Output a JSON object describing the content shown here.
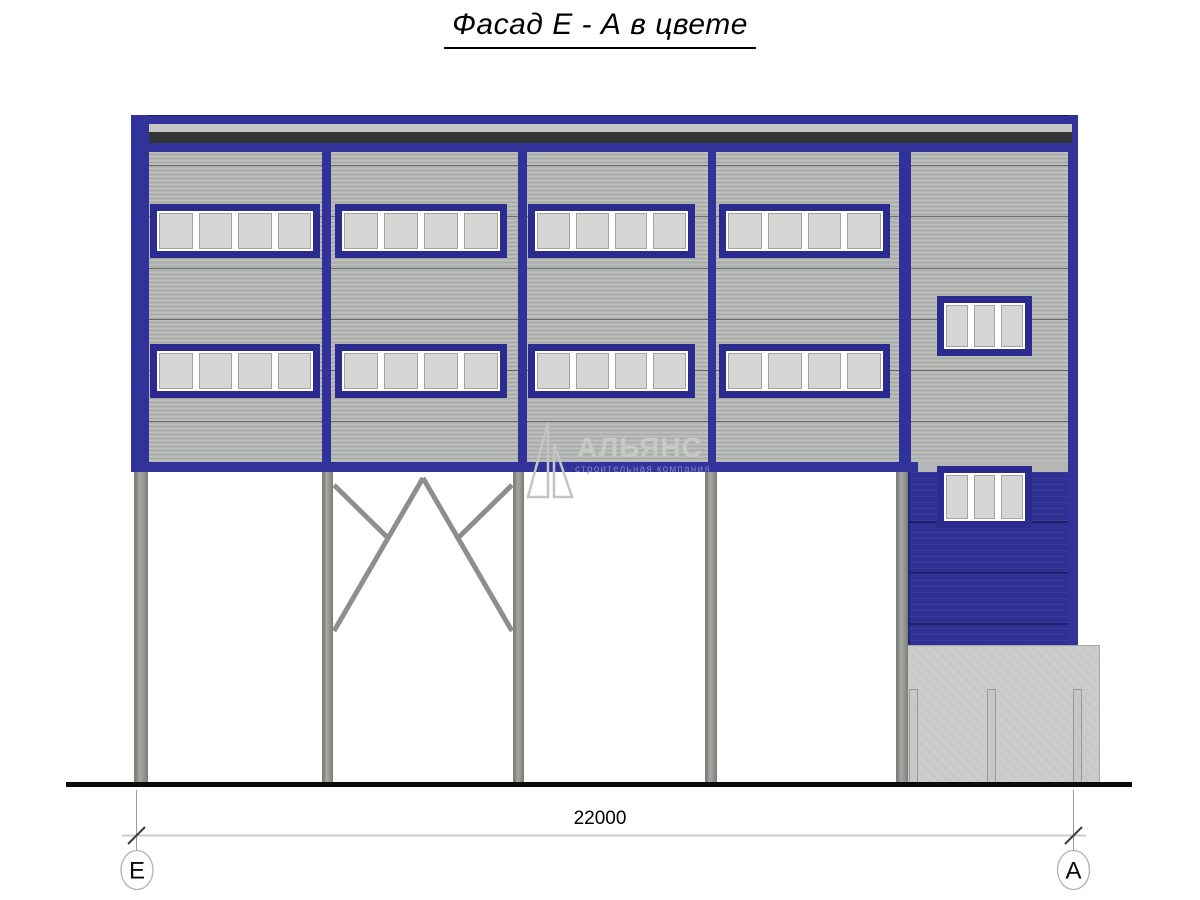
{
  "title": "Фасад Е - А в цвете",
  "watermark": {
    "name": "АЛЬЯНС",
    "tagline": "строительная компания"
  },
  "dimension": {
    "length_mm": "22000"
  },
  "axes": {
    "left": "Е",
    "right": "А"
  },
  "colors": {
    "accent_blue": "#32329b",
    "frame_blue": "#2b2b8f",
    "annex_blue": "#2e3094",
    "wall_gray": "#b4b7b3",
    "roof_dark": "#323435",
    "roof_light": "#c5c7c3",
    "column_gray": "#9b9d9a",
    "concrete_gray": "#cccdca",
    "pane_gray": "#d6d7d4",
    "ground_black": "#0b0b0b"
  },
  "facade": {
    "bays": 4,
    "window_rows_y": [
      204,
      344
    ],
    "window_height": 54,
    "bay_windows": [
      {
        "x": 150,
        "w": 170
      },
      {
        "x": 335,
        "w": 172
      },
      {
        "x": 528,
        "w": 167
      },
      {
        "x": 719,
        "w": 171
      }
    ],
    "main_window_panes": 4,
    "annex_windows": [
      {
        "x": 937,
        "y": 296,
        "w": 95,
        "h": 60,
        "panes": 3
      },
      {
        "x": 937,
        "y": 466,
        "w": 95,
        "h": 62,
        "panes": 3
      }
    ],
    "divider_xs": [
      [
        322,
        9
      ],
      [
        518,
        9
      ],
      [
        708,
        8
      ],
      [
        899,
        12
      ]
    ],
    "column_bars": [
      [
        134,
        14
      ],
      [
        322,
        11
      ],
      [
        513,
        11
      ],
      [
        705,
        12
      ],
      [
        896,
        12
      ]
    ],
    "seam_ys": [
      165,
      216,
      268,
      319,
      370,
      421
    ]
  }
}
